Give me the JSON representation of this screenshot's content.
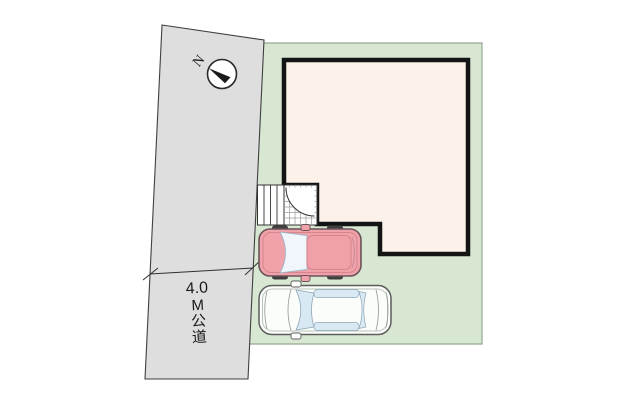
{
  "scene": {
    "type": "site-plan",
    "road_full_label": "4.0M公道"
  },
  "road": {
    "labels": [
      "4.0",
      "M",
      "公",
      "道"
    ]
  },
  "compass": {
    "label": "N"
  },
  "colors": {
    "background": "#ffffff",
    "road_fill": "#dedede",
    "road_edge": "#3f3f3f",
    "plot_fill": "#d7e7d2",
    "plot_edge": "#92a892",
    "building_fill": "#fcf2ea",
    "building_edge": "#141414",
    "porch_fill": "#ffffff",
    "grid_line": "#9b9b9b",
    "stairs_edge": "#333333",
    "car_pink_body": "#f0a2aa",
    "car_pink_detail": "#d8848e",
    "car_white_body": "#fbfdfa",
    "car_white_edge": "#5d5d5d",
    "car_window": "#d9e9f3",
    "wheel": "#3f3f3f",
    "dim_line": "#2f2f2f",
    "text": "#1a1a1a"
  }
}
